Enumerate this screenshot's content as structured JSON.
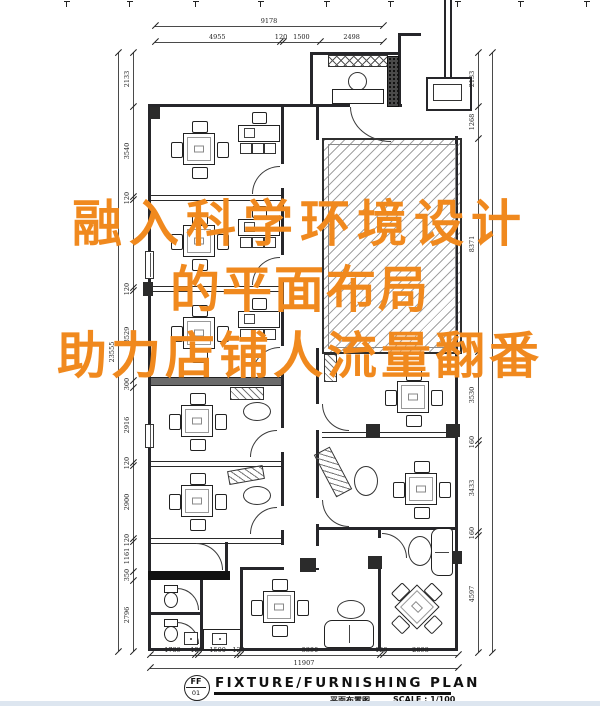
{
  "page": {
    "background": "#ffffff",
    "line_color": "#26262a",
    "accent_orange": "#F0891E"
  },
  "overlay": {
    "line1": "融入科学环境设计",
    "line2": "的平面布局",
    "line3": "助力店铺人流量翻番"
  },
  "dims": {
    "top": {
      "total": "9178",
      "segments": [
        "4955",
        "120",
        "1500",
        "2498"
      ]
    },
    "bottom": {
      "total": "11907",
      "segments": [
        "1739",
        "120",
        "1500",
        "120",
        "5390",
        "120",
        "2898"
      ]
    },
    "left": {
      "total": "23555",
      "segments": [
        "2133",
        "3540",
        "120",
        "",
        "120",
        "3529",
        "300",
        "2916",
        "120",
        "2900",
        "120",
        "1161",
        "350",
        "2796"
      ]
    },
    "right": {
      "segments": [
        "2133",
        "1268",
        "8371",
        "3530",
        "160",
        "3433",
        "160",
        "4597"
      ]
    }
  },
  "title_block": {
    "ref_top": "FF",
    "ref_bottom": "01",
    "title": "FIXTURE/FURNISHING PLAN",
    "subtitle": "平面布置图",
    "scale": "SCALE : 1/100"
  }
}
